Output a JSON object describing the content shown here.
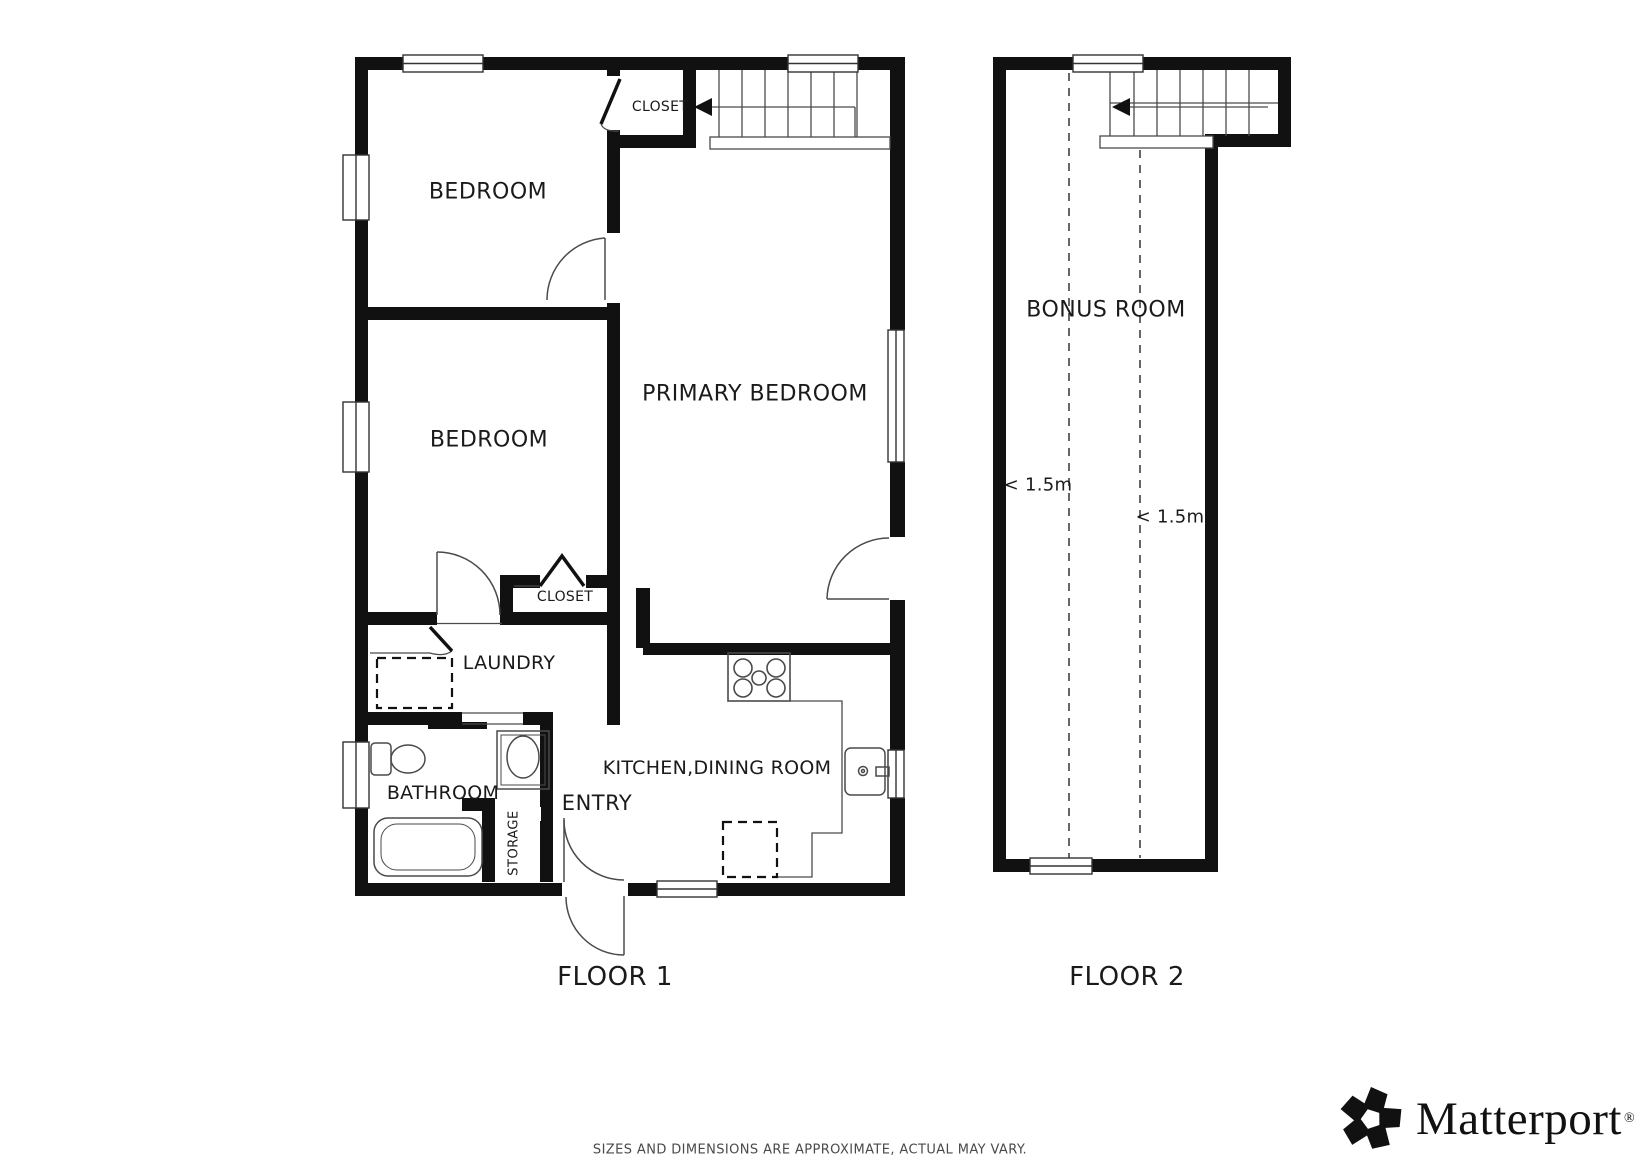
{
  "floor1": {
    "label": "FLOOR 1",
    "rooms": {
      "bedroom1": "BEDROOM",
      "bedroom2": "BEDROOM",
      "primary_bedroom": "PRIMARY BEDROOM",
      "closet_top": "CLOSET",
      "closet_mid": "CLOSET",
      "laundry": "LAUNDRY",
      "bathroom": "BATHROOM",
      "storage": "STORAGE",
      "kitchen_dining": "KITCHEN,DINING ROOM",
      "entry": "ENTRY"
    }
  },
  "floor2": {
    "label": "FLOOR 2",
    "rooms": {
      "bonus_room": "BONUS ROOM"
    },
    "annotations": {
      "height1": "< 1.5m",
      "height2": "< 1.5m"
    }
  },
  "footer": {
    "disclaimer": "SIZES AND DIMENSIONS ARE APPROXIMATE, ACTUAL MAY VARY.",
    "brand": "Matterport",
    "registered_mark": "®"
  },
  "colors": {
    "wall": "#111111",
    "thin_line": "#4a4a4a",
    "text": "#1a1a1a",
    "background": "#ffffff"
  }
}
